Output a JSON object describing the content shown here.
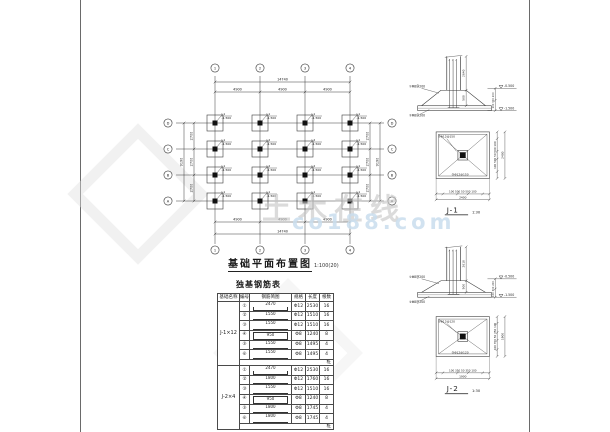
{
  "watermark": {
    "brand": "土木在线",
    "domain": "co188.com"
  },
  "plan": {
    "title": "基础平面布置图",
    "scale": "1:100(20)",
    "col_axes": [
      "1",
      "2",
      "3",
      "4"
    ],
    "row_axes": [
      "D",
      "C",
      "B",
      "A"
    ],
    "top_dims": {
      "total": "14740",
      "segments": [
        "4900",
        "4900",
        "4900"
      ]
    },
    "bottom_dims": {
      "total": "14740",
      "segments": [
        "4900",
        "4900",
        "4900"
      ]
    },
    "left_dims": {
      "total": "9190",
      "segments": [
        "2700",
        "2700",
        "2700"
      ]
    },
    "right_dims": {
      "total": "9190",
      "segments": [
        "2700",
        "2700",
        "2700"
      ]
    },
    "footings": [
      {
        "row": 0,
        "col": 0,
        "type": "J-1",
        "elev": "-1.500"
      },
      {
        "row": 0,
        "col": 1,
        "type": "J-1",
        "elev": "-1.500"
      },
      {
        "row": 0,
        "col": 2,
        "type": "J-1",
        "elev": "-1.500"
      },
      {
        "row": 0,
        "col": 3,
        "type": "J-1",
        "elev": "-1.500"
      },
      {
        "row": 1,
        "col": 0,
        "type": "J-1",
        "elev": "-1.500"
      },
      {
        "row": 1,
        "col": 1,
        "type": "J-2",
        "elev": "-1.500"
      },
      {
        "row": 1,
        "col": 2,
        "type": "J-2",
        "elev": "-1.500"
      },
      {
        "row": 1,
        "col": 3,
        "type": "J-1",
        "elev": "-1.500"
      },
      {
        "row": 2,
        "col": 0,
        "type": "J-1",
        "elev": "-1.500"
      },
      {
        "row": 2,
        "col": 1,
        "type": "J-2",
        "elev": "-1.500"
      },
      {
        "row": 2,
        "col": 2,
        "type": "J-2",
        "elev": "-1.500"
      },
      {
        "row": 2,
        "col": 3,
        "type": "J-1",
        "elev": "-1.500"
      },
      {
        "row": 3,
        "col": 0,
        "type": "J-1",
        "elev": "-1.500"
      },
      {
        "row": 3,
        "col": 1,
        "type": "J-1",
        "elev": "-1.500"
      },
      {
        "row": 3,
        "col": 2,
        "type": "J-1",
        "elev": "-1.500"
      },
      {
        "row": 3,
        "col": 3,
        "type": "J-1",
        "elev": "-1.500"
      }
    ]
  },
  "table": {
    "title": "独基钢筋表",
    "columns": [
      "基础名称",
      "编号",
      "钢筋简图",
      "规格",
      "长度",
      "根数"
    ],
    "groups": [
      {
        "name": "J-1×12",
        "rows": [
          {
            "no": "①",
            "dim": "2470",
            "shape": "hooks-up",
            "spec": "Φ12",
            "len": "2530",
            "qty": "16"
          },
          {
            "no": "②",
            "dim": "1550",
            "shape": "plain",
            "spec": "Φ12",
            "len": "1510",
            "qty": "16"
          },
          {
            "no": "③",
            "dim": "1550",
            "shape": "plain",
            "spec": "Φ12",
            "len": "1510",
            "qty": "16"
          },
          {
            "no": "④",
            "dim": "950",
            "shape": "box",
            "spec": "Φ8",
            "len": "1240",
            "qty": "8"
          },
          {
            "no": "⑤",
            "dim": "1550",
            "shape": "hooks-down",
            "spec": "Φ8",
            "len": "1495",
            "qty": "4"
          },
          {
            "no": "⑥",
            "dim": "1550",
            "shape": "hooks-down",
            "spec": "Φ8",
            "len": "1495",
            "qty": "4"
          }
        ],
        "note": "桩"
      },
      {
        "name": "J-2×4",
        "rows": [
          {
            "no": "①",
            "dim": "2470",
            "shape": "hooks-up",
            "spec": "Φ12",
            "len": "2530",
            "qty": "16"
          },
          {
            "no": "②",
            "dim": "1800",
            "shape": "plain",
            "spec": "Φ12",
            "len": "1760",
            "qty": "16"
          },
          {
            "no": "③",
            "dim": "1550",
            "shape": "plain",
            "spec": "Φ12",
            "len": "1510",
            "qty": "16"
          },
          {
            "no": "④",
            "dim": "950",
            "shape": "box",
            "spec": "Φ8",
            "len": "1240",
            "qty": "8"
          },
          {
            "no": "⑤",
            "dim": "1800",
            "shape": "hooks-down",
            "spec": "Φ8",
            "len": "1745",
            "qty": "4"
          },
          {
            "no": "⑥",
            "dim": "1800",
            "shape": "hooks-down",
            "spec": "Φ8",
            "len": "1745",
            "qty": "4"
          }
        ],
        "note": "桩"
      }
    ]
  },
  "details": [
    {
      "id": "J-1",
      "scale": "1:30",
      "elev_top": "-0.500",
      "elev_bot": "-1.500",
      "col_dim": "2640",
      "step_dim": "500",
      "right_stack": "100 300 200",
      "left_labels": [
        "①Φ8@200",
        "②Φ8@200"
      ],
      "plan_labels": [
        "①Φ12@150",
        "②Φ12@150"
      ],
      "bottom_dims": "100 500 50 500 100",
      "bottom_total": "2400",
      "right_dims": "100 500 50 500 100",
      "right_total": "2400"
    },
    {
      "id": "J-2",
      "scale": "1:30",
      "elev_top": "-0.500",
      "elev_bot": "-1.500",
      "col_dim": "2610",
      "step_dim": "500",
      "right_stack": "100 300 200",
      "left_labels": [
        "①Φ8@200",
        "②Φ8@200"
      ],
      "plan_labels": [
        "①Φ12@120",
        "②Φ12@120"
      ],
      "bottom_dims": "100 350 50 350 100",
      "bottom_total": "1900",
      "right_dims": "100 350 50 350 100",
      "right_total": "1900"
    }
  ]
}
